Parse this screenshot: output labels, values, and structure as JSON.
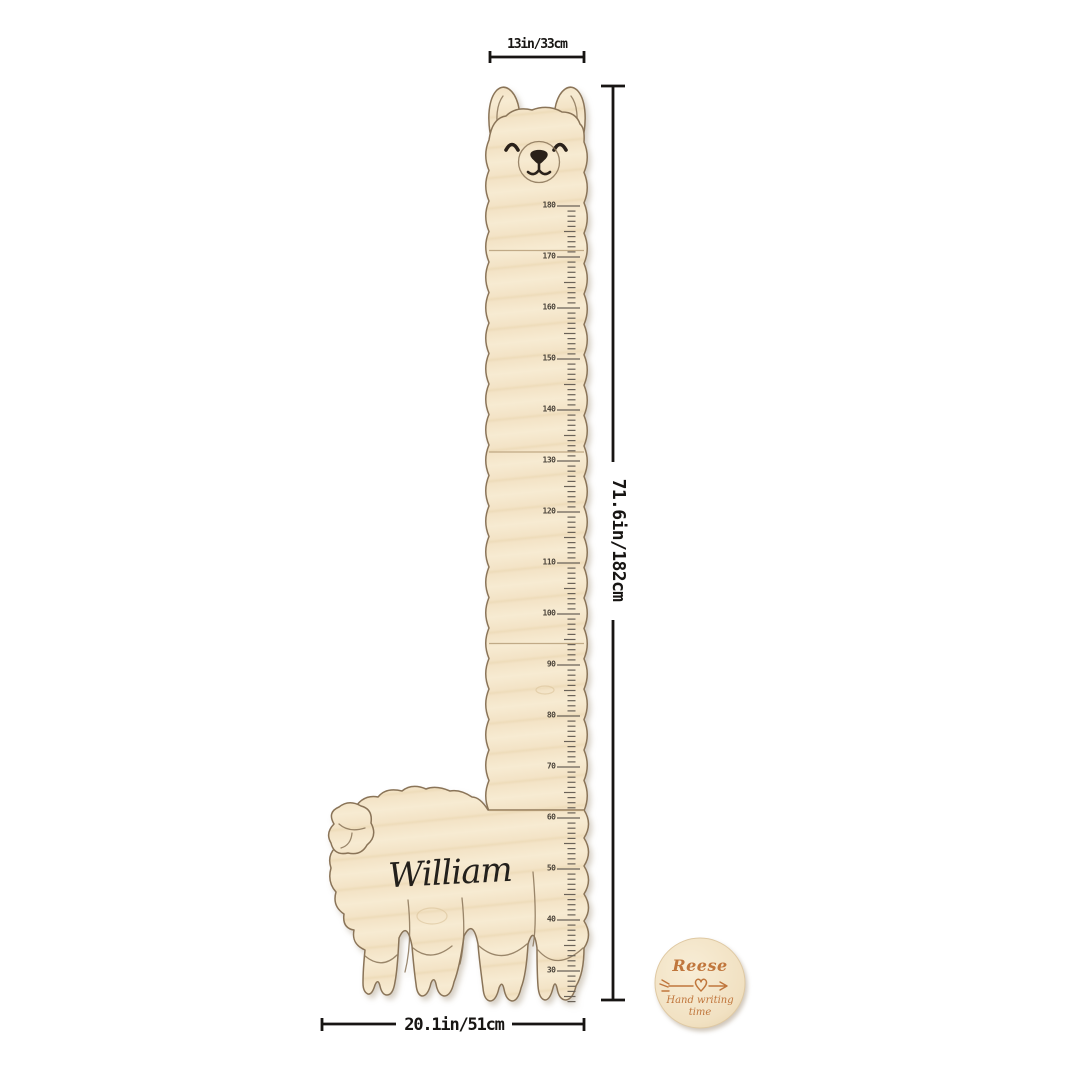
{
  "page": {
    "background": "#ffffff"
  },
  "annotations": {
    "head_width": "13in/33cm",
    "total_height": "71.6in/182cm",
    "body_width": "20.1in/51cm"
  },
  "engraving": {
    "name": "William"
  },
  "ruler": {
    "unit": "cm",
    "max_cm": 180,
    "min_cm": 30,
    "minor_tick_min_cm": 24,
    "major_marks_cm": [
      180,
      170,
      160,
      150,
      140,
      130,
      120,
      110,
      100,
      90,
      80,
      70,
      60,
      50,
      40,
      30
    ]
  },
  "badge": {
    "name": "Reese",
    "caption_line1": "Hand writing",
    "caption_line2": "time",
    "icon": "heart-arrow-icon"
  },
  "colors": {
    "wood": "#f4e5c8",
    "outline": "#8a7458",
    "ink": "#23201c",
    "dimension": "#171513",
    "ruler_mark": "#4d463c",
    "badge_text": "#c0763c"
  }
}
